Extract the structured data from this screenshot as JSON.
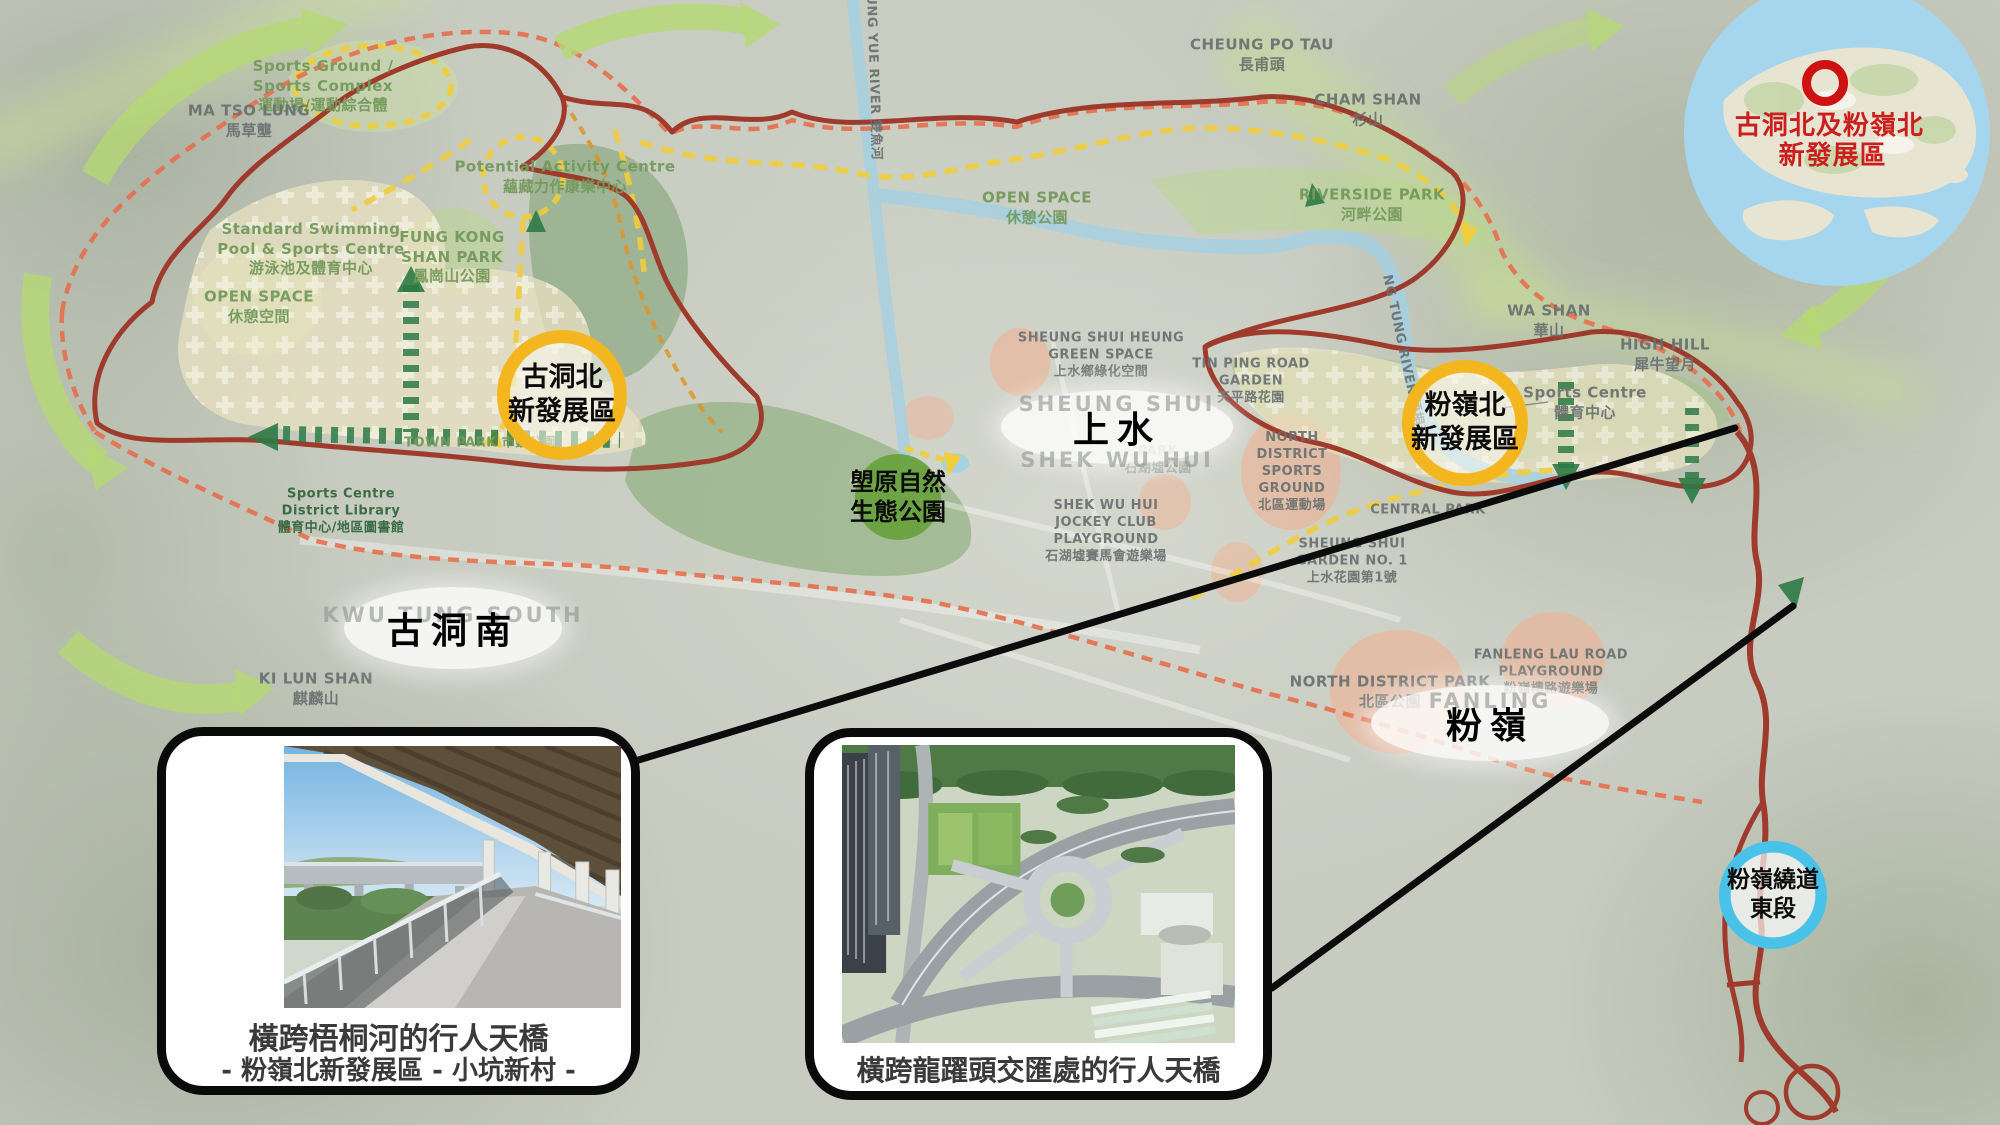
{
  "inset": {
    "line1": "古洞北及粉嶺北",
    "line2": "新發展區"
  },
  "badges": {
    "kwu_tung_north": {
      "line1": "古洞北",
      "line2": "新發展區"
    },
    "fanling_north": {
      "line1": "粉嶺北",
      "line2": "新發展區"
    },
    "long_valley": {
      "line1": "塱原自然",
      "line2": "生態公園"
    },
    "fanling_bypass": {
      "line1": "粉嶺繞道",
      "line2": "東段"
    }
  },
  "area_ellipses": {
    "sheung_shui": {
      "zh": "上水",
      "en": "SHEUNG SHUI",
      "en2": "SHEK WU HUI"
    },
    "kwu_tung_south": {
      "zh": "古洞南",
      "en": "KWU TUNG SOUTH"
    },
    "fanling": {
      "zh": "粉嶺",
      "en": "FANLING"
    }
  },
  "callouts": {
    "bridge_river": {
      "caption": "橫跨梧桐河的行人天橋",
      "subcaption": "- 粉嶺北新發展區 - 小坑新村 -"
    },
    "bridge_interchange": {
      "caption": "橫跨龍躍頭交匯處的行人天橋"
    }
  },
  "map_labels": {
    "sports_ground": {
      "lines": [
        "Sports Ground /",
        "Sports Complex",
        "運動場/運動綜合體"
      ]
    },
    "ma_tso_lung": {
      "lines": [
        "MA TSO LUNG",
        "馬草壟"
      ]
    },
    "potential_activity": {
      "lines": [
        "Potential Activity Centre",
        "蘊藏力作康樂中心"
      ]
    },
    "standard_swimming": {
      "lines": [
        "Standard Swimming",
        "Pool & Sports Centre",
        "游泳池及體育中心"
      ]
    },
    "fung_kong_shan": {
      "lines": [
        "FUNG KONG",
        "SHAN PARK",
        "鳳崗山公園"
      ]
    },
    "open_space_nw": {
      "lines": [
        "OPEN SPACE",
        "休憩空間"
      ]
    },
    "sheung_yue_river": {
      "lines": [
        "SHEUNG YUE RIVER  雙魚河"
      ]
    },
    "cheung_po_tau": {
      "lines": [
        "CHEUNG PO TAU",
        "長甫頭"
      ]
    },
    "cham_shan": {
      "lines": [
        "CHAM SHAN",
        "杉山"
      ]
    },
    "riverside_park": {
      "lines": [
        "RIVERSIDE PARK",
        "河畔公園"
      ]
    },
    "open_space_river": {
      "lines": [
        "OPEN SPACE",
        "休憩公園"
      ]
    },
    "wa_shan": {
      "lines": [
        "WA SHAN",
        "華山"
      ]
    },
    "high_hill": {
      "lines": [
        "HIGH HILL",
        "犀牛望月"
      ]
    },
    "sports_centre_e": {
      "lines": [
        "Sports Centre",
        "體育中心"
      ]
    },
    "sheung_shui_heung": {
      "lines": [
        "SHEUNG SHUI HEUNG",
        "GREEN SPACE",
        "上水鄉綠化空間"
      ]
    },
    "tin_ping_road": {
      "lines": [
        "TIN PING ROAD",
        "GARDEN",
        "天平路花園"
      ]
    },
    "swh_park": {
      "lines": [
        "PARK",
        "石湖墟公園"
      ]
    },
    "north_district_sg": {
      "lines": [
        "NORTH",
        "DISTRICT",
        "SPORTS",
        "GROUND",
        "北區運動場"
      ]
    },
    "swh_jockey": {
      "lines": [
        "SHEK WU HUI",
        "JOCKEY CLUB",
        "PLAYGROUND",
        "石湖墟賽馬會遊樂場"
      ]
    },
    "ss_garden1": {
      "lines": [
        "SHEUNG SHUI",
        "GARDEN NO. 1",
        "上水花園第1號"
      ]
    },
    "central_park": {
      "lines": [
        "CENTRAL PARK"
      ]
    },
    "ng_tung_river": {
      "lines": [
        "NG TUNG RIVER  梧桐河"
      ]
    },
    "north_district_park": {
      "lines": [
        "NORTH DISTRICT PARK",
        "北區公園"
      ]
    },
    "fanleng_lau": {
      "lines": [
        "FANLENG LAU ROAD",
        "PLAYGROUND",
        "粉嶺樓路遊樂場"
      ]
    },
    "ki_lun_shan": {
      "lines": [
        "KI LUN SHAN",
        "麒麟山"
      ]
    },
    "town_park": {
      "lines": [
        "TOWN PARK 市鎮公園"
      ]
    },
    "sports_library": {
      "lines": [
        "Sports Centre",
        "District Library",
        "體育中心/地區圖書館"
      ]
    }
  },
  "colors": {
    "nda_boundary_red": "#9e3b2d",
    "outer_boundary_dashed": "#e56f4d",
    "route_yellow": "#f0cd3c",
    "green_arrow": "#b5d873",
    "dark_green_corridor": "#2c7a45",
    "badge_orange": "#f3b61e",
    "badge_blue": "#49c2ea",
    "badge_green": "#68a23c",
    "inset_sea_blue": "#a5d6ee",
    "inset_marker_red": "#ce1212"
  }
}
